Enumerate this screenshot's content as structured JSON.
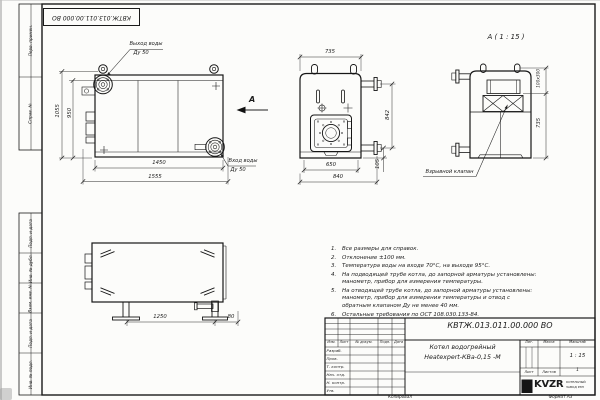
{
  "frame": {
    "stamp_top": "КВТЖ.013.011.00.000 ВО",
    "margin_top": [
      "Перв. примен.",
      "Справ. №"
    ],
    "margin_bottom": [
      "Подп. и дата",
      "Инв. № дубл.",
      "Взам. инв. №",
      "Подп. и дата",
      "Инв. № подл."
    ]
  },
  "views": {
    "front": {
      "outlet_line1": "Выход воды",
      "outlet_line2": "Ду 50",
      "inlet_line1": "Вход воды",
      "inlet_line2": "Ду 50",
      "arrow_label": "А",
      "dim_height_outer": "1055",
      "dim_height_inner": "950",
      "dim_width_inner": "1450",
      "dim_width_outer": "1555"
    },
    "end": {
      "dim_top": "735",
      "dim_bottom_inner": "650",
      "dim_bottom_outer": "840",
      "dim_right": "842",
      "dim_base": "105"
    },
    "detail": {
      "title": "А ( 1 : 15 )",
      "dim_duct": "100х300",
      "dim_height": "735",
      "valve_label": "Взрывной клапан"
    },
    "plan": {
      "dim_span": "1250",
      "dim_offset": "80"
    }
  },
  "notes": [
    {
      "num": "1.",
      "text": "Все размеры для справок."
    },
    {
      "num": "2.",
      "text": "Отклонение ±100 мм."
    },
    {
      "num": "3.",
      "text": "Температура воды на входе 70°С, на выходе 95°С."
    },
    {
      "num": "4.",
      "text": "На подводящей трубе котла, до запорной арматуры установлены: манометр, прибор для измерения температуры."
    },
    {
      "num": "5.",
      "text": "На отводящей трубе котла, до запорной арматуры установлены: манометр, прибор для измерения температуры и отвод с обратным клапаном Ду не менее 40 мм."
    },
    {
      "num": "6.",
      "text": "Остальные требования по ОСТ 108.030.133-84."
    }
  ],
  "title_block": {
    "doc_number": "КВТЖ.013.011.00.000 ВО",
    "product_name_line1": "Котел водогрейный",
    "product_name_line2": "Heatexpert-КВа-0,15 -М",
    "header_cells": [
      "Изм.",
      "Лист",
      "№ докум.",
      "Подп.",
      "Дата"
    ],
    "role_rows": [
      "Разраб.",
      "Пров.",
      "Т. контр.",
      "Нач. отд.",
      "Н. контр.",
      "Утв."
    ],
    "lit_label": "Лит.",
    "mass_label": "Масса",
    "scale_label": "Масштаб",
    "scale_value": "1 : 15",
    "sheet_label": "Лист",
    "sheets_label": "Листов",
    "sheets_value": "1",
    "logo_text": "KVZR",
    "logo_sub_line1": "КОТЕЛЬНЫЙ",
    "logo_sub_line2": "ЗАВОД РЭП",
    "copied_label": "Копировал",
    "format_label": "Формат А3"
  }
}
